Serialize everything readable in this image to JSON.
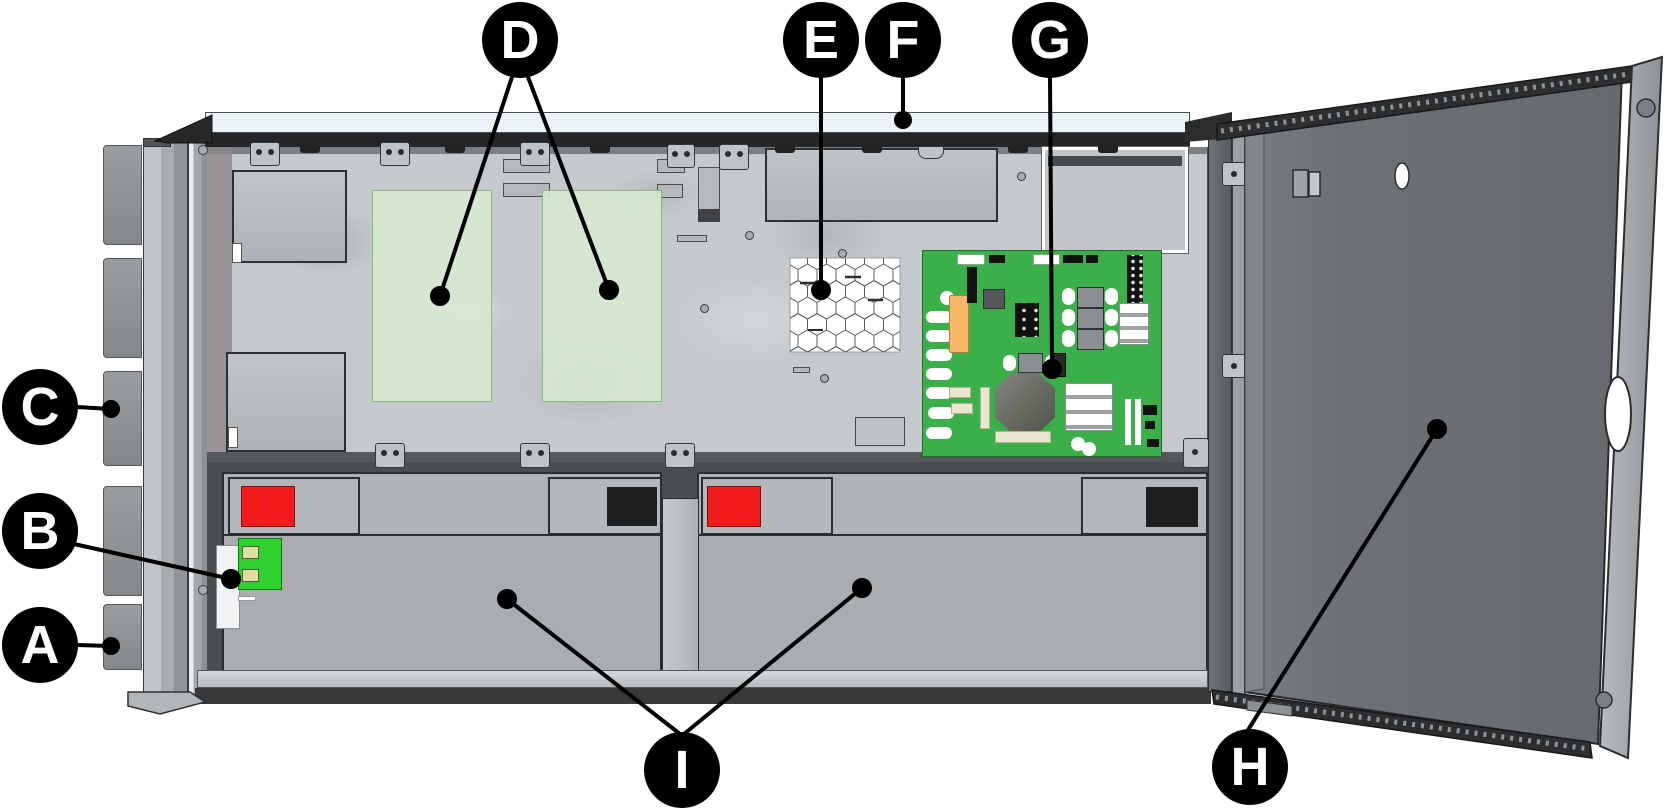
{
  "figure": {
    "kind": "technical-illustration",
    "description_visible_text_count": 9
  },
  "callouts": [
    {
      "letter": "A"
    },
    {
      "letter": "B"
    },
    {
      "letter": "C"
    },
    {
      "letter": "D"
    },
    {
      "letter": "E"
    },
    {
      "letter": "F"
    },
    {
      "letter": "G"
    },
    {
      "letter": "H"
    },
    {
      "letter": "I"
    }
  ],
  "colors": {
    "callout_bg": "#000000",
    "callout_text": "#ffffff",
    "pcb_green": "#3bb04a",
    "option_board_green": "#d8e9d1",
    "battery_terminal_red": "#f11b1b",
    "battery_terminal_black": "#1d1f21",
    "wire_connector_green": "#2fd12f",
    "orange_component": "#f6b76b",
    "door_gray": "#6e7174",
    "battery_gray": "#a9adb0",
    "chassis_gray": "#c6c9cb",
    "rail_dark": "#232527"
  }
}
